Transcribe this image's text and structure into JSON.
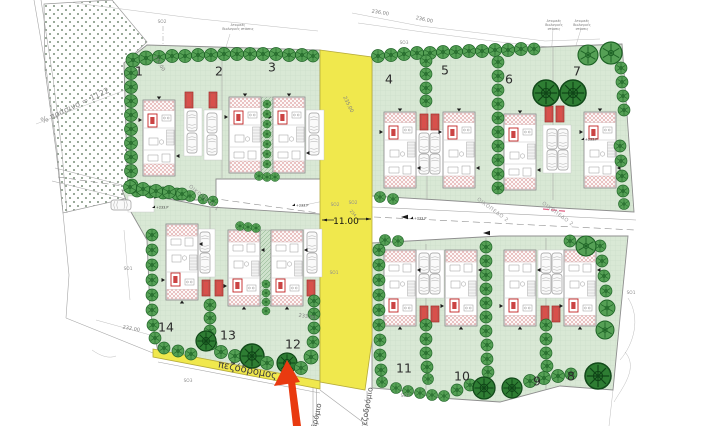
{
  "plots": [
    {
      "number": "1"
    },
    {
      "number": "2"
    },
    {
      "number": "3"
    },
    {
      "number": "4"
    },
    {
      "number": "5"
    },
    {
      "number": "6"
    },
    {
      "number": "7"
    },
    {
      "number": "8"
    },
    {
      "number": "9"
    },
    {
      "number": "10"
    },
    {
      "number": "11"
    },
    {
      "number": "12"
    },
    {
      "number": "13"
    },
    {
      "number": "14"
    }
  ],
  "roads": {
    "road_1_label": "ΟΙΚΟΠΕΔΟ 1",
    "road_2_label": "ΟΙΚΟΠΕΔΟ 2",
    "width_dimension": "11.00"
  },
  "paths": {
    "pedestrian_path": "πεζόδρομος",
    "sidewalk": "πεζοδρόμιο"
  },
  "contours": {
    "c232": "232.00",
    "c233": "233.00",
    "c234": "234",
    "c235": "235.00",
    "c236": "236.00"
  },
  "survey_points": {
    "so1": "SO1",
    "so2": "SO2",
    "so3": "SO3"
  },
  "annotations": {
    "green_area_note": "% πράσινο = 1122",
    "septic_l1": "Ατομικές",
    "septic_l2": "Βιολογικές",
    "septic_l3": "στάσεις",
    "septic_l23": "Βιολογικές στάσεις",
    "spot_level": "+233.P"
  },
  "colors": {
    "plot-green": "#d9e8d5",
    "grid-green": "#c3d8c0",
    "tree-green": "#55a055",
    "tree-dark": "#2e7d33",
    "tree-stroke": "#1e6326",
    "road-yellow": "#f0e84d",
    "yellow-border": "#b5aa3a",
    "planter-red": "#d8504b",
    "arrow-red": "#e93a10",
    "hatch-pink": "#dd9e9e"
  }
}
